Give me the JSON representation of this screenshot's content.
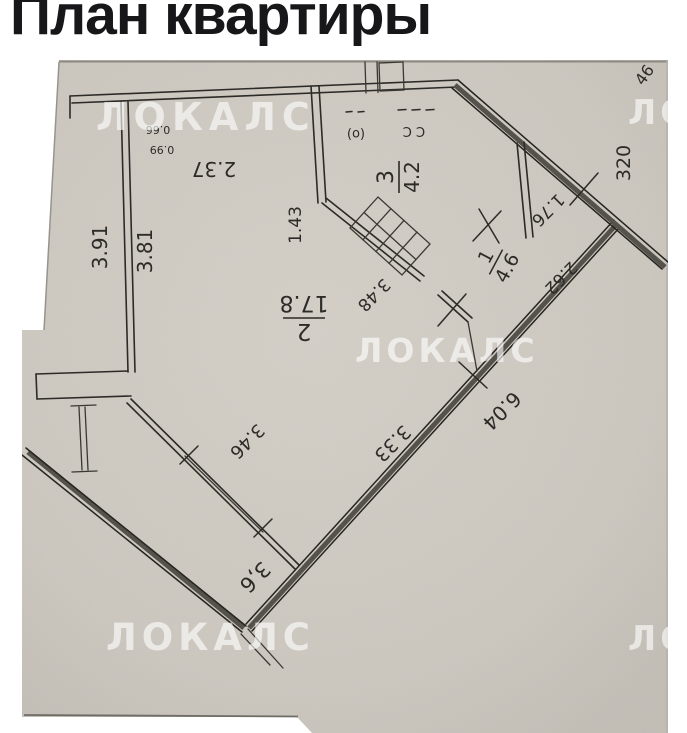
{
  "title": "План квартиры",
  "watermark": {
    "text": "ЛОКАЛС"
  },
  "plan": {
    "rooms": {
      "r2": {
        "num": "2",
        "area": "17.8"
      },
      "r3": {
        "num": "3",
        "area": "4.2"
      },
      "r1": {
        "num": "1",
        "area": "4.6"
      }
    },
    "dims": {
      "left_outer": "3.91",
      "left_inner": "3.81",
      "top_width": "2.37",
      "small_upper": "0.66",
      "small_lower": "0.99",
      "hall_wall": "1.43",
      "inner_wall": "3.48",
      "window": "3.46",
      "diag_inner": "3.33",
      "diag_outer": "6.04",
      "balcony": "3,6",
      "hall_diag": "2.62",
      "upper_right": "1.76",
      "right_outer": "320",
      "corner_partial": "46"
    },
    "fixtures": {
      "mark_a": "(о)",
      "mark_b": "С С"
    }
  },
  "colors": {
    "paper": "#cfcac2",
    "line": "#2d2b27",
    "watermark": "rgba(255,255,255,0.62)",
    "title": "#17171a"
  }
}
